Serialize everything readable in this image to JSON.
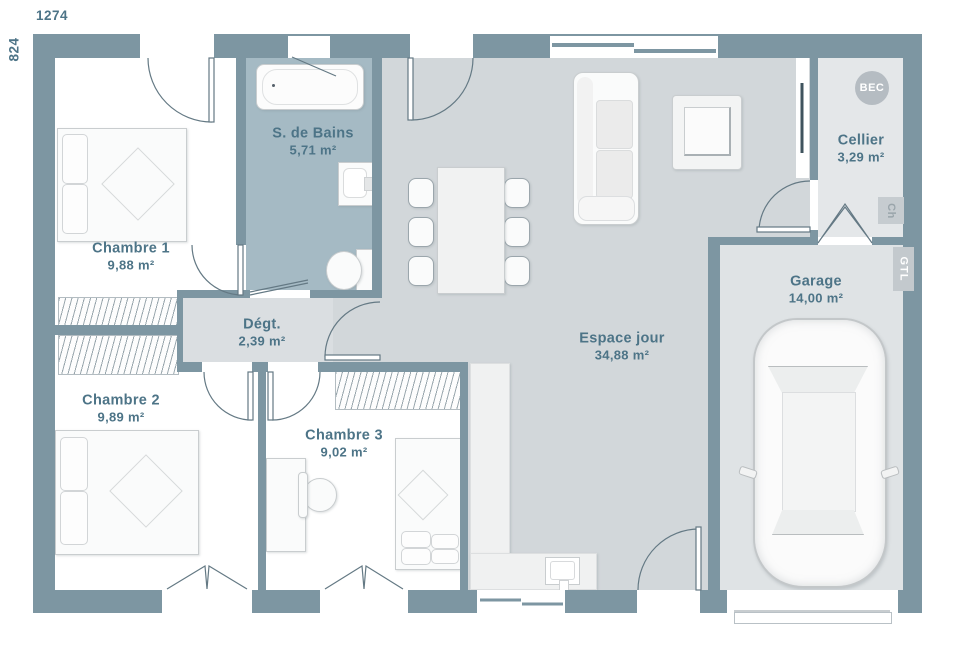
{
  "meta": {
    "width_dim": "1274",
    "height_dim": "824"
  },
  "rooms": {
    "chambre1": {
      "name": "Chambre 1",
      "area": "9,88 m²"
    },
    "chambre2": {
      "name": "Chambre 2",
      "area": "9,89 m²"
    },
    "chambre3": {
      "name": "Chambre 3",
      "area": "9,02 m²"
    },
    "sdb": {
      "name": "S. de Bains",
      "area": "5,71 m²"
    },
    "degt": {
      "name": "Dégt.",
      "area": "2,39 m²"
    },
    "espace": {
      "name": "Espace jour",
      "area": "34,88 m²"
    },
    "cellier": {
      "name": "Cellier",
      "area": "3,29 m²"
    },
    "garage": {
      "name": "Garage",
      "area": "14,00 m²"
    }
  },
  "tags": {
    "bec": "BEC",
    "ch": "Ch",
    "gtl": "GTL"
  },
  "colors": {
    "wall": "#7d96a2",
    "accent_text": "#4d7487",
    "sdb_floor": "#a5bac4",
    "living_floor": "#d2d7da",
    "hall_floor": "#dadee1",
    "cellier_floor": "#e4e7e9",
    "garage_floor": "#dfe3e5"
  }
}
